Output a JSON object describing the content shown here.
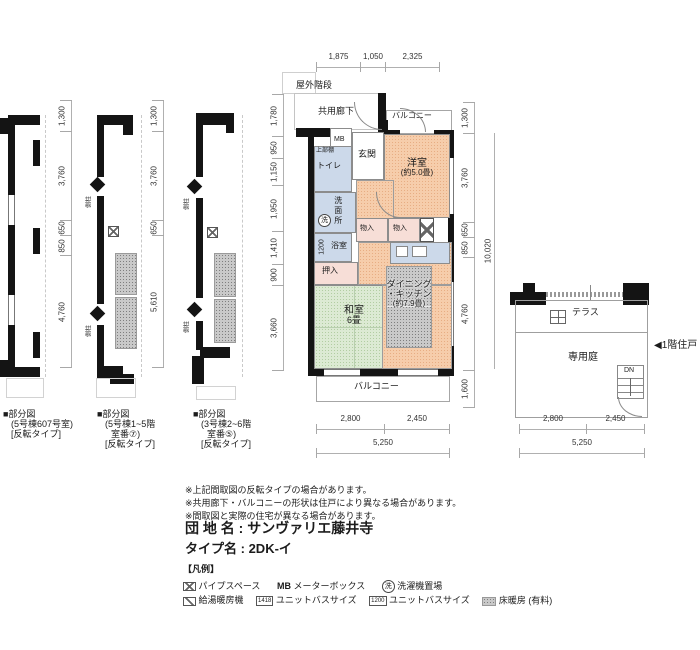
{
  "top_dims": {
    "d1": "1,875",
    "d2": "1,050",
    "d3": "2,325"
  },
  "corridor": {
    "outdoor_stairs": "屋外階段",
    "label": "共用廊下"
  },
  "main": {
    "balcony_top": "バルコニー",
    "balcony_bottom": "バルコニー",
    "mb": "MB",
    "entrance": "玄関",
    "upper_shelf": "上部棚",
    "toilet": "トイレ",
    "washroom": "洗面所",
    "wash": "洗",
    "bath": "浴室",
    "bath_size": "1200",
    "oshiire": "押入",
    "mono1": "物入",
    "mono2": "物入",
    "west_name": "洋室",
    "west_size": "(約5.0畳)",
    "tatami_name": "和室",
    "tatami_size": "6畳",
    "dk1": "ダイニング",
    "dk2": "・キッチン",
    "dk3": "(約7.9畳)"
  },
  "dims_left": [
    "1,780",
    "950",
    "1,150",
    "1,950",
    "1,410",
    "900",
    "3,660"
  ],
  "dims_right": [
    "1,300",
    "3,760",
    "650",
    "850",
    "4,760",
    "1,600"
  ],
  "dims_right_total": "10,020",
  "dims_bottom": {
    "d1": "2,800",
    "d2": "2,450",
    "total": "5,250"
  },
  "plan1": {
    "dims": [
      "1,300",
      "3,760",
      "650",
      "850",
      "4,760"
    ]
  },
  "plan2": {
    "dims": [
      "1,300",
      "3,760",
      "650",
      "5,610"
    ]
  },
  "pillar_label": "側柱",
  "captions": {
    "c1": [
      "■部分図",
      "(5号棟607号室)",
      "[反転タイプ]"
    ],
    "c2": [
      "■部分図",
      "(5号棟1~5階",
      "室番⑦)",
      "[反転タイプ]"
    ],
    "c3": [
      "■部分図",
      "(3号棟2~6階",
      "室番⑤)",
      "[反転タイプ]"
    ]
  },
  "right_plan": {
    "terrace": "テラス",
    "garden": "専用庭",
    "dn": "DN",
    "arrow_label": "◀1階住戸",
    "d1": "2,800",
    "d2": "2,450",
    "total": "5,250"
  },
  "notes": [
    "※上記間取図の反転タイプの場合があります。",
    "※共用廊下・バルコニーの形状は住戸により異なる場合があります。",
    "※間取図と実際の住宅が異なる場合があります。"
  ],
  "estate": {
    "label": "団 地 名 :",
    "name": "サンヴァリエ藤井寺",
    "type_label": "タイプ名 :",
    "type": "2DK-イ"
  },
  "legend": {
    "title": "【凡例】",
    "pipe": "パイプスペース",
    "mb_icon": "MB",
    "mb": "メーターボックス",
    "wash_icon": "洗",
    "wash": "洗濯機置場",
    "heater": "給湯暖房機",
    "ub1_icon": "1418",
    "ub1": "ユニットバスサイズ",
    "ub2_icon": "1200",
    "ub2": "ユニットバスサイズ",
    "floorheat": "床暖房 (有料)"
  },
  "colors": {
    "wall": "#141414",
    "peach": "#f6cdab",
    "green": "#dcead3",
    "blue": "#ccd9ea",
    "pink": "#f7ded7",
    "hatch": "#c9c9c9"
  }
}
